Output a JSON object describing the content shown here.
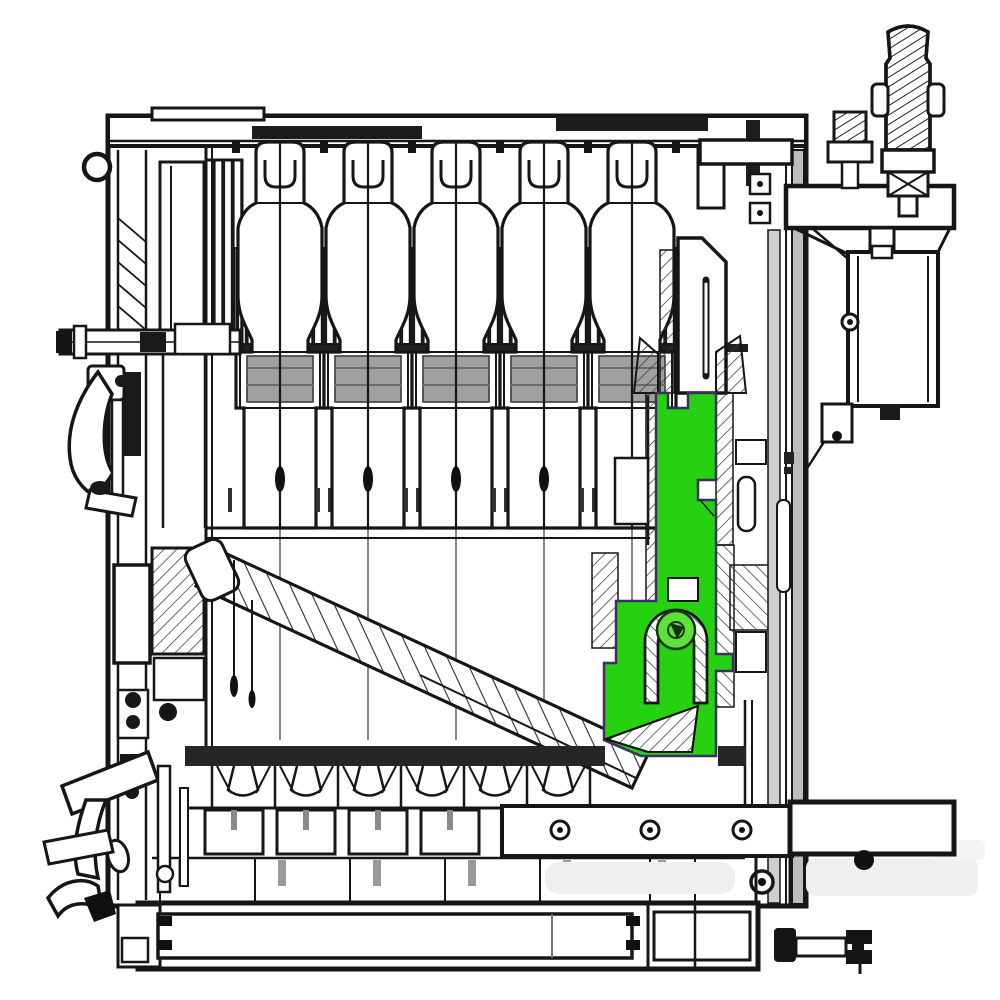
{
  "meta": {
    "description": "Monochrome sectional engineering drawing of a solid-fuel heating boiler, cut side view. One internal rear-flue baffle part is highlighted in bright green. No readable text labels are present in the drawing.",
    "visible_text": []
  },
  "colors": {
    "background": "#ffffff",
    "line": "#161616",
    "highlight": "#26d112",
    "highlight_bright": "#5fe03a",
    "highlight_stroke": "#3b2f63",
    "wall_gray": "#cfcfcf",
    "casing_gray": "#bdbdbd",
    "dark_fill": "#262626",
    "trough_gray": "#a0a0a0",
    "dash_gray": "#8a8a8a",
    "watermark_gray": "#efefef"
  }
}
